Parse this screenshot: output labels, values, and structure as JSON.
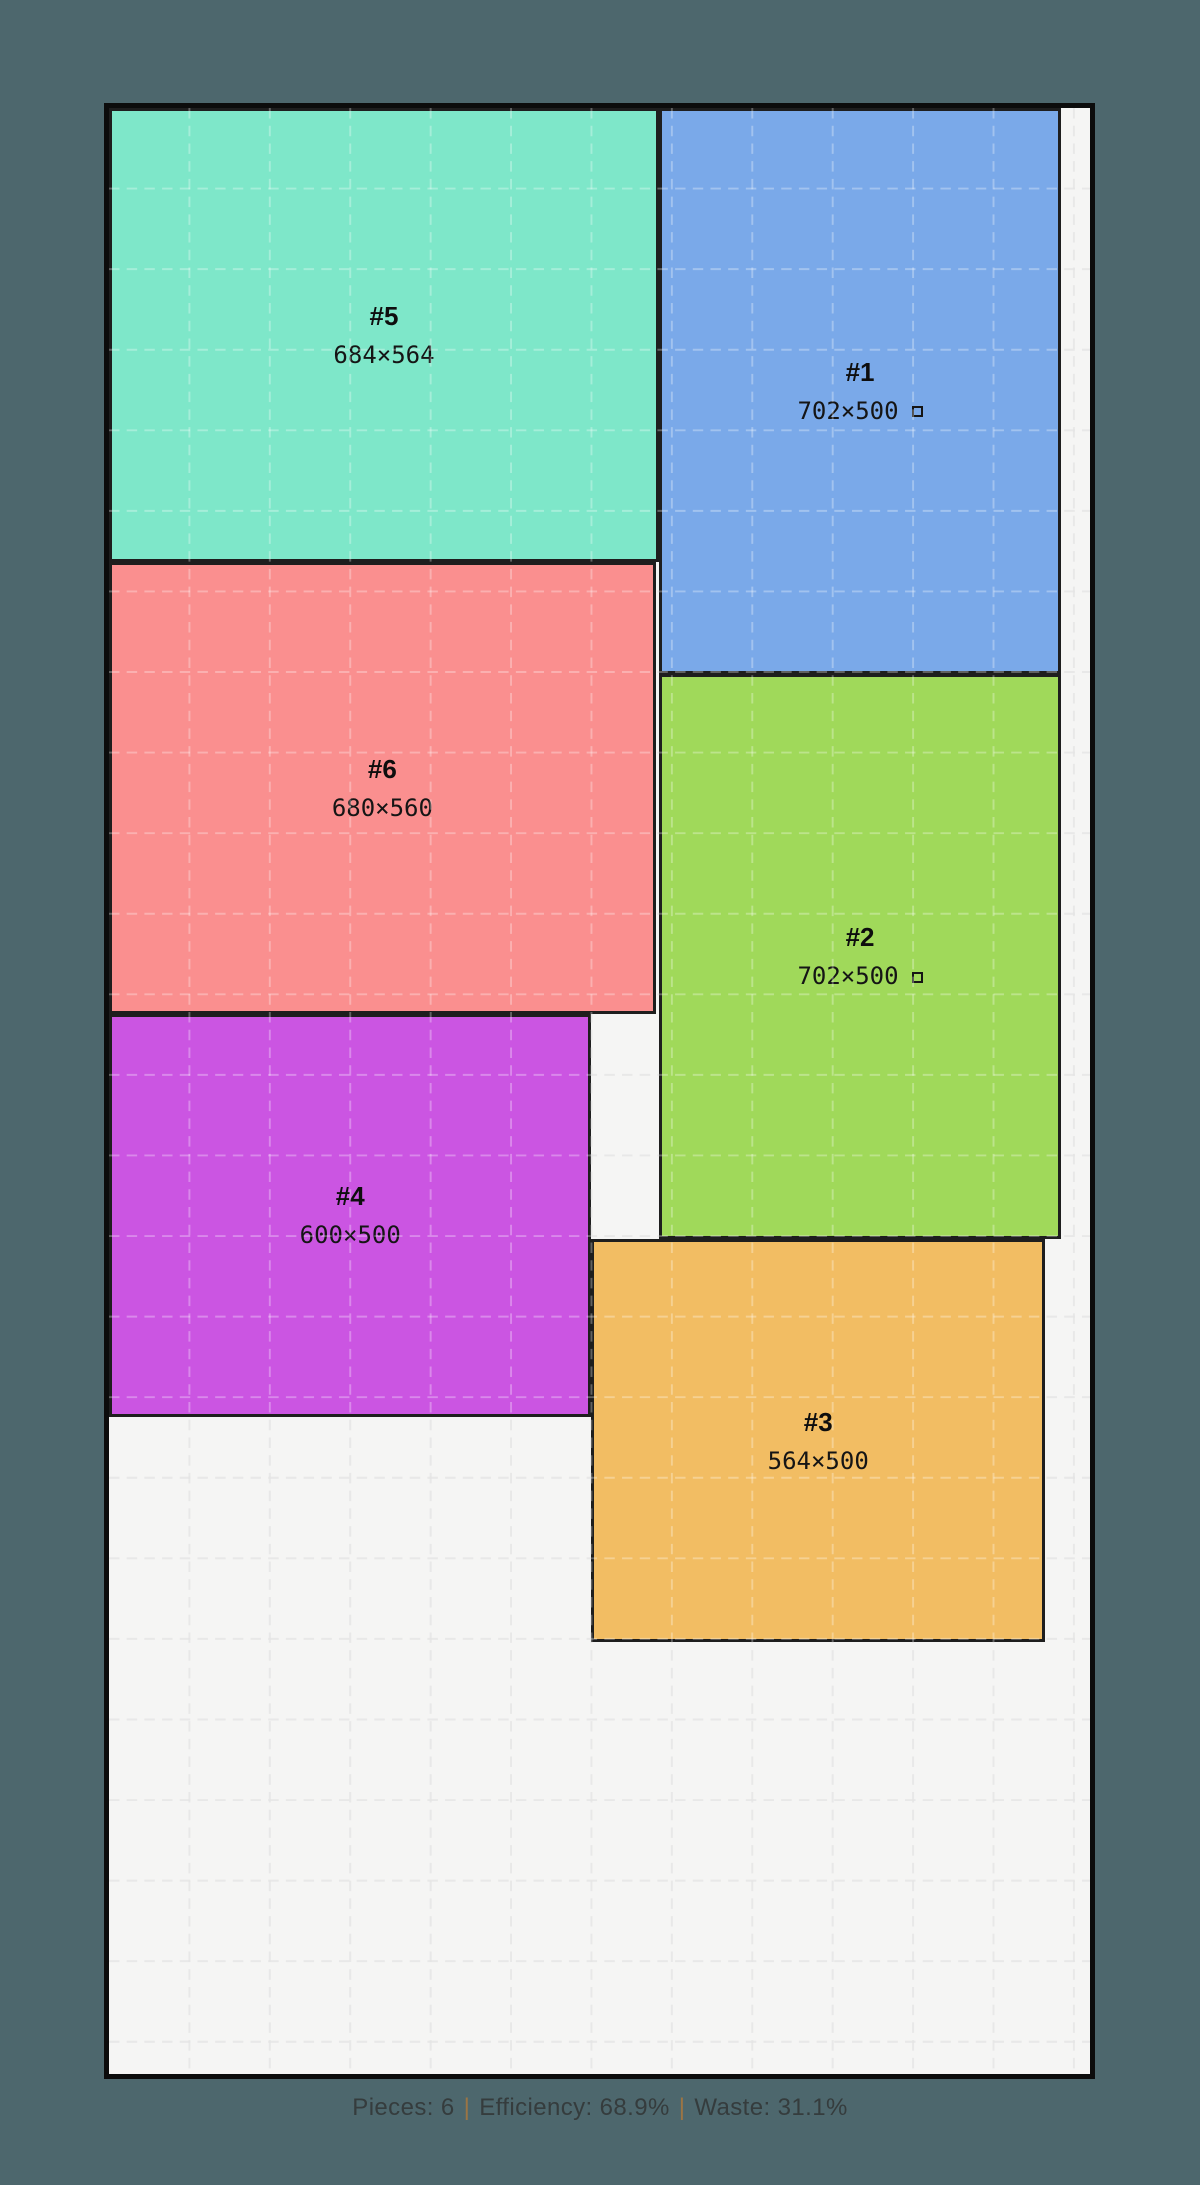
{
  "canvas": {
    "background_color": "#4d676d"
  },
  "layout": {
    "sheet": {
      "width_units": 1220,
      "height_units": 2440,
      "fill_color": "#f5f5f4",
      "border_color": "#0c0c0c",
      "grid_step_units": 100,
      "grid_color_on_sheet": "rgba(0,0,0,0.085)",
      "grid_color_on_pieces": "rgba(255,255,255,0.30)"
    },
    "pieces": [
      {
        "id": "#5",
        "dims": "684×564",
        "x": 0,
        "y": 0,
        "w": 684,
        "h": 564,
        "color": "#7ee7c9",
        "rotated": false
      },
      {
        "id": "#1",
        "dims": "702×500",
        "x": 684,
        "y": 0,
        "w": 500,
        "h": 702,
        "color": "#7aa9e9",
        "rotated": true
      },
      {
        "id": "#6",
        "dims": "680×560",
        "x": 0,
        "y": 564,
        "w": 680,
        "h": 560,
        "color": "#fa8f8f",
        "rotated": false
      },
      {
        "id": "#2",
        "dims": "702×500",
        "x": 684,
        "y": 702,
        "w": 500,
        "h": 702,
        "color": "#a0d95a",
        "rotated": true
      },
      {
        "id": "#4",
        "dims": "600×500",
        "x": 0,
        "y": 1124,
        "w": 600,
        "h": 500,
        "color": "#cb55e2",
        "rotated": false
      },
      {
        "id": "#3",
        "dims": "564×500",
        "x": 600,
        "y": 1404,
        "w": 564,
        "h": 500,
        "color": "#f2bd63",
        "rotated": false
      }
    ]
  },
  "footer": {
    "pieces": "Pieces: 6",
    "efficiency": "Efficiency: 68.9%",
    "waste": "Waste: 31.1%",
    "separator": "|"
  }
}
